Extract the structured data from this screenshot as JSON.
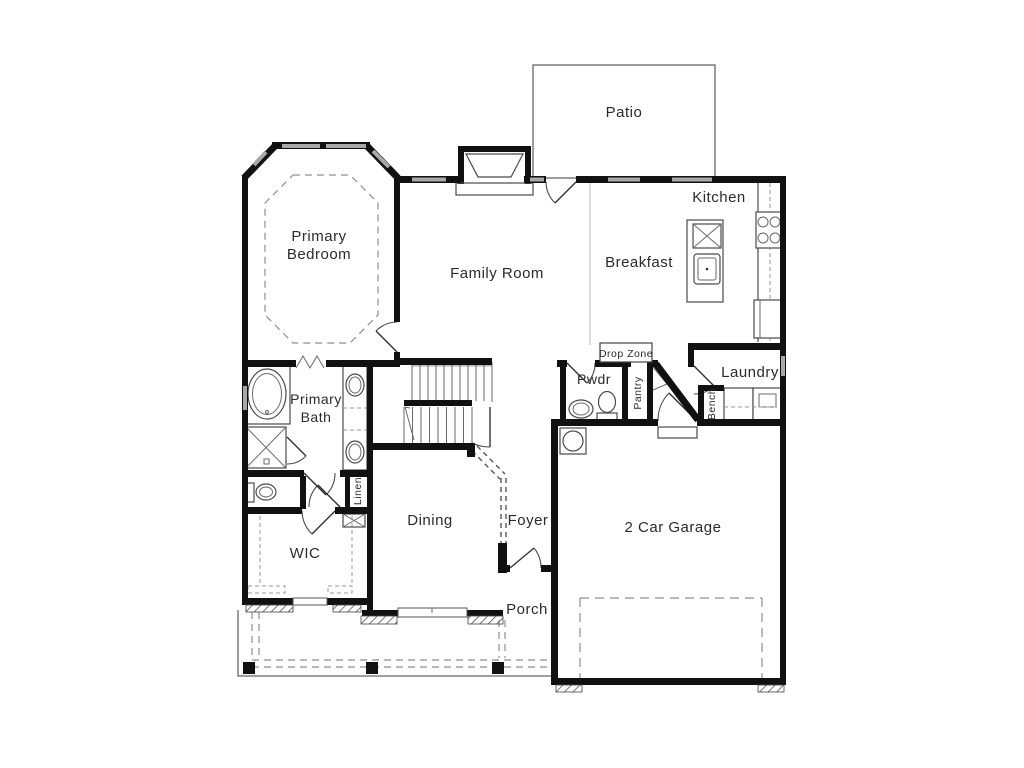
{
  "rooms": {
    "patio": "Patio",
    "kitchen": "Kitchen",
    "breakfast": "Breakfast",
    "family_room": "Family Room",
    "primary_bedroom": [
      "Primary",
      "Bedroom"
    ],
    "primary_bath": [
      "Primary",
      "Bath"
    ],
    "powder": "Pwdr",
    "drop_zone": "Drop Zone",
    "pantry": "Pantry",
    "laundry": "Laundry",
    "bench": "Bench",
    "linen": "Linen",
    "wic": "WIC",
    "dining": "Dining",
    "foyer": "Foyer",
    "garage": "2 Car Garage",
    "porch": "Porch"
  },
  "colors": {
    "wall": "#111111",
    "window_fill": "#a8a8a8",
    "thin_line": "#4a4a4a",
    "dashed_line": "#8f8f8f",
    "text": "#2b2b2b",
    "background": "#ffffff"
  }
}
